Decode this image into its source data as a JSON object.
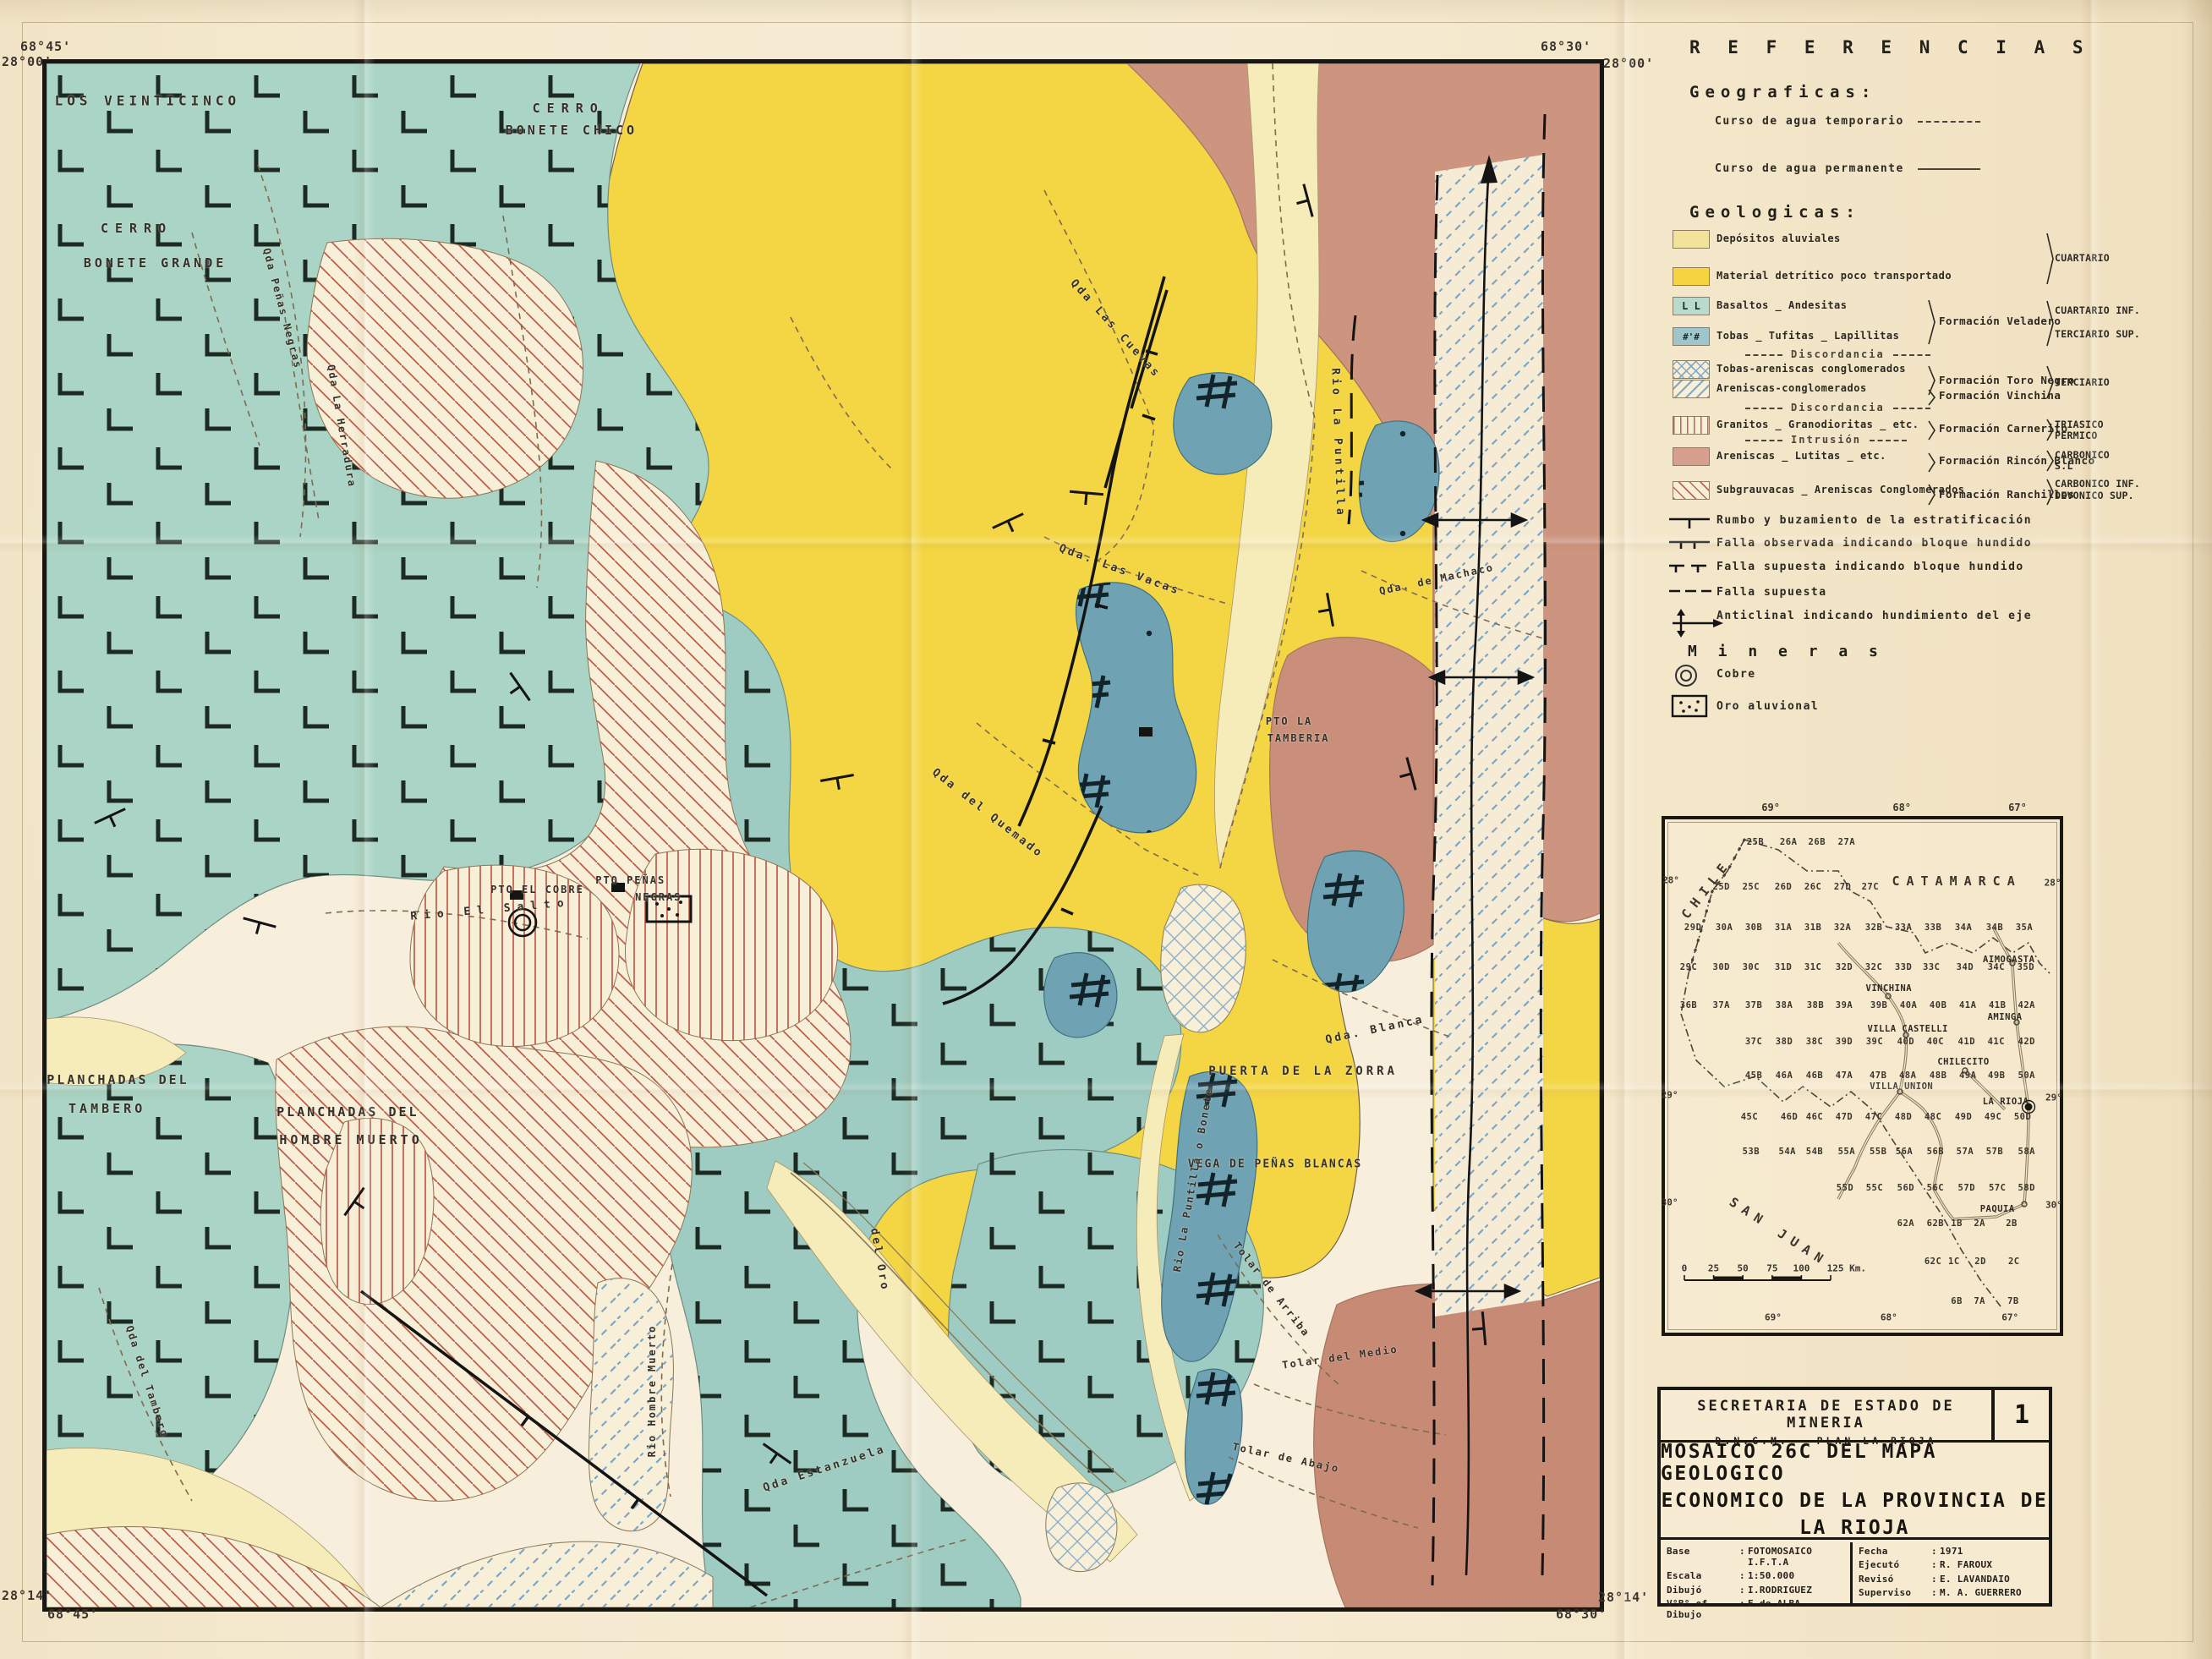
{
  "map": {
    "corners": {
      "tl_lon": "68°45'",
      "tl_lat": "28°00'",
      "tr_lon": "68°30'",
      "tr_lat": "28°00'",
      "bl_lat": "28°14'",
      "bl_lon": "68°45'",
      "br_lat": "28°14'",
      "br_lon": "68°30'"
    },
    "labels": [
      {
        "t": "LOS VEINTICINCO",
        "x": 6.5,
        "y": 2.4,
        "r": 0,
        "fs": 16,
        "ls": 5
      },
      {
        "t": "CERRO",
        "x": 33.6,
        "y": 2.9,
        "r": 0,
        "fs": 15,
        "ls": 8
      },
      {
        "t": "BONETE CHICO",
        "x": 33.8,
        "y": 4.3,
        "r": 0,
        "fs": 15,
        "ls": 4
      },
      {
        "t": "CERRO",
        "x": 5.8,
        "y": 10.7,
        "r": 0,
        "fs": 15,
        "ls": 8
      },
      {
        "t": "BONETE GRANDE",
        "x": 7.0,
        "y": 12.9,
        "r": 0,
        "fs": 15,
        "ls": 4
      },
      {
        "t": "PLANCHADAS DEL",
        "x": 4.6,
        "y": 65.8,
        "r": 0,
        "fs": 15,
        "ls": 3
      },
      {
        "t": "TAMBERO",
        "x": 3.9,
        "y": 67.7,
        "r": 0,
        "fs": 15,
        "ls": 4
      },
      {
        "t": "PLANCHADAS DEL",
        "x": 19.4,
        "y": 67.9,
        "r": 0,
        "fs": 15,
        "ls": 3
      },
      {
        "t": "HOMBRE MUERTO",
        "x": 19.6,
        "y": 69.7,
        "r": 0,
        "fs": 15,
        "ls": 4
      },
      {
        "t": "PUERTA DE LA ZORRA",
        "x": 80.9,
        "y": 65.3,
        "r": 0,
        "fs": 14,
        "ls": 4
      },
      {
        "t": "VEGA DE PEÑAS BLANCAS",
        "x": 79.1,
        "y": 71.3,
        "r": 0,
        "fs": 13,
        "ls": 2
      },
      {
        "t": "PTO LA",
        "x": 80.0,
        "y": 42.6,
        "r": 0,
        "fs": 12,
        "ls": 2
      },
      {
        "t": "TAMBERIA",
        "x": 80.6,
        "y": 43.7,
        "r": 0,
        "fs": 12,
        "ls": 2
      },
      {
        "t": "PTO EL COBRE",
        "x": 31.6,
        "y": 53.5,
        "r": 0,
        "fs": 12,
        "ls": 2
      },
      {
        "t": "PTO PEÑAS",
        "x": 37.6,
        "y": 52.9,
        "r": 0,
        "fs": 12,
        "ls": 2
      },
      {
        "t": "NEGRAS",
        "x": 39.4,
        "y": 54.0,
        "r": 0,
        "fs": 12,
        "ls": 2
      },
      {
        "t": "Qda Las Cuevas",
        "x": 68.8,
        "y": 17.2,
        "r": 48,
        "fs": 13,
        "ls": 3
      },
      {
        "t": "Qda. Las Vacas",
        "x": 69.1,
        "y": 32.8,
        "r": 20,
        "fs": 13,
        "ls": 3
      },
      {
        "t": "Rio La Puntilla",
        "x": 83.1,
        "y": 24.6,
        "r": 88,
        "fs": 13,
        "ls": 4
      },
      {
        "t": "Qda del Quemado",
        "x": 60.6,
        "y": 48.6,
        "r": 38,
        "fs": 13,
        "ls": 3
      },
      {
        "t": "Qda. Blanca",
        "x": 85.5,
        "y": 62.6,
        "r": -12,
        "fs": 13,
        "ls": 3
      },
      {
        "t": "Qda. de Machaco",
        "x": 89.5,
        "y": 33.4,
        "r": -12,
        "fs": 12,
        "ls": 2
      },
      {
        "t": "Rio El Salto",
        "x": 28.6,
        "y": 54.8,
        "r": -5,
        "fs": 13,
        "ls": 8
      },
      {
        "t": "del Oro",
        "x": 53.6,
        "y": 77.5,
        "r": 80,
        "fs": 13,
        "ls": 3
      },
      {
        "t": "Qda Estanzuela",
        "x": 50.1,
        "y": 91.0,
        "r": -18,
        "fs": 13,
        "ls": 3
      },
      {
        "t": "Rio Hombre Muerto",
        "x": 39.0,
        "y": 86.0,
        "r": -90,
        "fs": 12,
        "ls": 2
      },
      {
        "t": "Tolar de Arriba",
        "x": 78.9,
        "y": 79.4,
        "r": 52,
        "fs": 12,
        "ls": 2
      },
      {
        "t": "Tolar del Medio",
        "x": 83.3,
        "y": 83.8,
        "r": -8,
        "fs": 12,
        "ls": 2
      },
      {
        "t": "Tolar de Abajo",
        "x": 79.8,
        "y": 90.3,
        "r": 12,
        "fs": 12,
        "ls": 2
      },
      {
        "t": "Rio La Puntilla o Bonete",
        "x": 73.8,
        "y": 72.3,
        "r": -80,
        "fs": 12,
        "ls": 2
      },
      {
        "t": "Qda del Tambero",
        "x": 6.5,
        "y": 85.4,
        "r": 72,
        "fs": 12,
        "ls": 2
      },
      {
        "t": "Qda Peñas Negras",
        "x": 15.2,
        "y": 15.9,
        "r": 75,
        "fs": 12,
        "ls": 2
      },
      {
        "t": "Qda La Herradura",
        "x": 19.0,
        "y": 23.5,
        "r": 80,
        "fs": 12,
        "ls": 2
      }
    ]
  },
  "legend": {
    "title": "R E F E R E N C I A S",
    "geograficas": {
      "heading": "Geograficas:",
      "items": [
        {
          "icon": "water-dashed",
          "label": "Curso de agua temporario"
        },
        {
          "icon": "water-solid",
          "label": "Curso de agua permanente"
        }
      ]
    },
    "geologicas": {
      "heading": "Geologicas:",
      "rows": [
        {
          "kind": "unit",
          "swatch": "aluvial",
          "label": "Depósitos  aluviales"
        },
        {
          "kind": "unit",
          "swatch": "detritico",
          "label": "Material  detrítico  poco transportado"
        },
        {
          "kind": "unit",
          "swatch": "basaltos",
          "label": "Basaltos _ Andesitas"
        },
        {
          "kind": "unit",
          "swatch": "tobas",
          "label": "Tobas _ Tufitas _ Lapillitas"
        },
        {
          "kind": "sep",
          "label": "Discordancia"
        },
        {
          "kind": "unit",
          "swatch": "toronegro",
          "label": "Tobas-areniscas conglomerados"
        },
        {
          "kind": "unit",
          "swatch": "vinchina",
          "label": "Areniscas-conglomerados"
        },
        {
          "kind": "sep",
          "label": "Discordancia"
        },
        {
          "kind": "unit",
          "swatch": "granitos",
          "label": "Granitos _ Granodioritas _ etc."
        },
        {
          "kind": "sep",
          "label": "Intrusión"
        },
        {
          "kind": "unit",
          "swatch": "rincon",
          "label": "Areniscas _ Lutitas _ etc."
        },
        {
          "kind": "unit",
          "swatch": "ranchillos",
          "label": "Subgrauvacas _ Areniscas Conglomerados"
        }
      ],
      "formations": [
        {
          "label": "Formación Veladero"
        },
        {
          "label": "Formación Toro Negro"
        },
        {
          "label": "Formación Vinchina"
        },
        {
          "label": "Formación Carnerito"
        },
        {
          "label": "Formación Rincón Blanco"
        },
        {
          "label": "Formación Ranchillos"
        }
      ],
      "ages": [
        {
          "lines": [
            "CUARTARIO"
          ]
        },
        {
          "lines": [
            "CUARTARIO INF.",
            "TERCIARIO SUP."
          ]
        },
        {
          "lines": [
            "TERCIARIO"
          ]
        },
        {
          "lines": [
            "TRIASICO",
            "PERMICO"
          ]
        },
        {
          "lines": [
            "CARBONICO",
            "S.L"
          ]
        },
        {
          "lines": [
            "CARBONICO INF.",
            "DEVONICO SUP."
          ]
        }
      ]
    },
    "symbols": [
      {
        "icon": "strike-dip",
        "label": "Rumbo y buzamiento de la estratificación"
      },
      {
        "icon": "fault-observed",
        "label": "Falla observada indicando bloque hundido"
      },
      {
        "icon": "fault-supposed-block",
        "label": "Falla supuesta indicando bloque hundido"
      },
      {
        "icon": "fault-supposed",
        "label": "Falla supuesta"
      },
      {
        "icon": "anticline",
        "label": "Anticlinal  indicando hundimiento del eje"
      }
    ],
    "mineras": {
      "heading": "M i n e r a s",
      "items": [
        {
          "icon": "copper",
          "label": "Cobre"
        },
        {
          "icon": "gold",
          "label": "Oro aluvional"
        }
      ]
    }
  },
  "index_map": {
    "cells": [
      {
        "id": "25B",
        "x": 22.9,
        "y": 4.4
      },
      {
        "id": "26A",
        "x": 31.3,
        "y": 4.4
      },
      {
        "id": "26B",
        "x": 38.5,
        "y": 4.4
      },
      {
        "id": "27A",
        "x": 46.0,
        "y": 4.4
      },
      {
        "id": "25D",
        "x": 14.3,
        "y": 13.2
      },
      {
        "id": "25C",
        "x": 21.8,
        "y": 13.2
      },
      {
        "id": "26D",
        "x": 30.0,
        "y": 13.2
      },
      {
        "id": "26C",
        "x": 37.5,
        "y": 13.2
      },
      {
        "id": "27D",
        "x": 45.0,
        "y": 13.2
      },
      {
        "id": "27C",
        "x": 52.0,
        "y": 13.2
      },
      {
        "id": "29D",
        "x": 7.1,
        "y": 21.1
      },
      {
        "id": "30A",
        "x": 15.0,
        "y": 21.1
      },
      {
        "id": "30B",
        "x": 22.5,
        "y": 21.1
      },
      {
        "id": "31A",
        "x": 30.0,
        "y": 21.1
      },
      {
        "id": "31B",
        "x": 37.5,
        "y": 21.1
      },
      {
        "id": "32A",
        "x": 45.0,
        "y": 21.1
      },
      {
        "id": "32B",
        "x": 52.9,
        "y": 21.1
      },
      {
        "id": "33A",
        "x": 60.4,
        "y": 21.1
      },
      {
        "id": "33B",
        "x": 67.9,
        "y": 21.1
      },
      {
        "id": "34A",
        "x": 75.6,
        "y": 21.1
      },
      {
        "id": "34B",
        "x": 83.5,
        "y": 21.1
      },
      {
        "id": "35A",
        "x": 91.0,
        "y": 21.1
      },
      {
        "id": "29C",
        "x": 6.0,
        "y": 28.8
      },
      {
        "id": "30D",
        "x": 14.3,
        "y": 28.8
      },
      {
        "id": "30C",
        "x": 21.8,
        "y": 28.8
      },
      {
        "id": "31D",
        "x": 30.0,
        "y": 28.8
      },
      {
        "id": "31C",
        "x": 37.5,
        "y": 28.8
      },
      {
        "id": "32D",
        "x": 45.4,
        "y": 28.8
      },
      {
        "id": "32C",
        "x": 52.9,
        "y": 28.8
      },
      {
        "id": "33D",
        "x": 60.4,
        "y": 28.8
      },
      {
        "id": "33C",
        "x": 67.5,
        "y": 28.8
      },
      {
        "id": "34D",
        "x": 76.0,
        "y": 28.8
      },
      {
        "id": "34C",
        "x": 83.9,
        "y": 28.8
      },
      {
        "id": "35D",
        "x": 91.4,
        "y": 28.8
      },
      {
        "id": "36B",
        "x": 6.0,
        "y": 36.2
      },
      {
        "id": "37A",
        "x": 14.3,
        "y": 36.2
      },
      {
        "id": "37B",
        "x": 22.5,
        "y": 36.2
      },
      {
        "id": "38A",
        "x": 30.2,
        "y": 36.2
      },
      {
        "id": "38B",
        "x": 38.1,
        "y": 36.2
      },
      {
        "id": "39A",
        "x": 45.4,
        "y": 36.2
      },
      {
        "id": "39B",
        "x": 54.2,
        "y": 36.2
      },
      {
        "id": "40A",
        "x": 61.7,
        "y": 36.2
      },
      {
        "id": "40B",
        "x": 69.2,
        "y": 36.2
      },
      {
        "id": "41A",
        "x": 76.7,
        "y": 36.2
      },
      {
        "id": "41B",
        "x": 84.2,
        "y": 36.2
      },
      {
        "id": "42A",
        "x": 91.6,
        "y": 36.2
      },
      {
        "id": "37C",
        "x": 22.5,
        "y": 43.3
      },
      {
        "id": "38D",
        "x": 30.2,
        "y": 43.3
      },
      {
        "id": "38C",
        "x": 37.9,
        "y": 43.3
      },
      {
        "id": "39D",
        "x": 45.4,
        "y": 43.3
      },
      {
        "id": "39C",
        "x": 53.1,
        "y": 43.3
      },
      {
        "id": "40D",
        "x": 61.0,
        "y": 43.3
      },
      {
        "id": "40C",
        "x": 68.5,
        "y": 43.3
      },
      {
        "id": "41D",
        "x": 76.4,
        "y": 43.3
      },
      {
        "id": "41C",
        "x": 83.9,
        "y": 43.3
      },
      {
        "id": "42D",
        "x": 91.6,
        "y": 43.3
      },
      {
        "id": "45B",
        "x": 22.5,
        "y": 49.9
      },
      {
        "id": "46A",
        "x": 30.2,
        "y": 49.9
      },
      {
        "id": "46B",
        "x": 37.9,
        "y": 49.9
      },
      {
        "id": "47A",
        "x": 45.4,
        "y": 49.9
      },
      {
        "id": "47B",
        "x": 54.0,
        "y": 49.9
      },
      {
        "id": "48A",
        "x": 61.5,
        "y": 49.9
      },
      {
        "id": "48B",
        "x": 69.2,
        "y": 49.9
      },
      {
        "id": "49A",
        "x": 76.7,
        "y": 49.9
      },
      {
        "id": "49B",
        "x": 84.0,
        "y": 49.9
      },
      {
        "id": "50A",
        "x": 91.6,
        "y": 49.9
      },
      {
        "id": "45C",
        "x": 21.4,
        "y": 58.0
      },
      {
        "id": "46D",
        "x": 31.5,
        "y": 58.0
      },
      {
        "id": "46C",
        "x": 37.9,
        "y": 58.0
      },
      {
        "id": "47D",
        "x": 45.4,
        "y": 58.0
      },
      {
        "id": "47C",
        "x": 52.9,
        "y": 58.0
      },
      {
        "id": "48D",
        "x": 60.4,
        "y": 58.0
      },
      {
        "id": "48C",
        "x": 67.9,
        "y": 58.0
      },
      {
        "id": "49D",
        "x": 75.6,
        "y": 58.0
      },
      {
        "id": "49C",
        "x": 83.1,
        "y": 58.0
      },
      {
        "id": "50D",
        "x": 90.6,
        "y": 58.0
      },
      {
        "id": "53B",
        "x": 21.8,
        "y": 64.7
      },
      {
        "id": "54A",
        "x": 31.0,
        "y": 64.7
      },
      {
        "id": "54B",
        "x": 37.9,
        "y": 64.7
      },
      {
        "id": "55A",
        "x": 46.0,
        "y": 64.7
      },
      {
        "id": "55B",
        "x": 54.0,
        "y": 64.7
      },
      {
        "id": "56A",
        "x": 60.6,
        "y": 64.7
      },
      {
        "id": "56B",
        "x": 68.5,
        "y": 64.7
      },
      {
        "id": "57A",
        "x": 76.0,
        "y": 64.7
      },
      {
        "id": "57B",
        "x": 83.5,
        "y": 64.7
      },
      {
        "id": "58A",
        "x": 91.6,
        "y": 64.7
      },
      {
        "id": "55D",
        "x": 45.6,
        "y": 71.8
      },
      {
        "id": "55C",
        "x": 53.1,
        "y": 71.8
      },
      {
        "id": "56D",
        "x": 61.0,
        "y": 71.8
      },
      {
        "id": "56C",
        "x": 68.5,
        "y": 71.8
      },
      {
        "id": "57D",
        "x": 76.4,
        "y": 71.8
      },
      {
        "id": "57C",
        "x": 84.2,
        "y": 71.8
      },
      {
        "id": "58D",
        "x": 91.6,
        "y": 71.8
      },
      {
        "id": "62A",
        "x": 61.0,
        "y": 78.7
      },
      {
        "id": "62B",
        "x": 68.5,
        "y": 78.7
      },
      {
        "id": "1B",
        "x": 73.9,
        "y": 78.7
      },
      {
        "id": "2A",
        "x": 79.7,
        "y": 78.7
      },
      {
        "id": "2B",
        "x": 87.8,
        "y": 78.7
      },
      {
        "id": "62C",
        "x": 67.9,
        "y": 86.2
      },
      {
        "id": "1C",
        "x": 73.2,
        "y": 86.2
      },
      {
        "id": "2D",
        "x": 79.9,
        "y": 86.2
      },
      {
        "id": "2C",
        "x": 88.4,
        "y": 86.2
      },
      {
        "id": "6B",
        "x": 73.9,
        "y": 93.9
      },
      {
        "id": "7A",
        "x": 79.7,
        "y": 93.9
      },
      {
        "id": "7B",
        "x": 88.2,
        "y": 93.9
      }
    ],
    "towns": [
      {
        "name": "AIMOGASTA",
        "x": 87.1,
        "y": 27.3
      },
      {
        "name": "VINCHINA",
        "x": 56.7,
        "y": 33.0
      },
      {
        "name": "AMINGA",
        "x": 86.1,
        "y": 38.6
      },
      {
        "name": "VILLA CASTELLI",
        "x": 61.5,
        "y": 40.8
      },
      {
        "name": "CHILECITO",
        "x": 75.6,
        "y": 47.2
      },
      {
        "name": "VILLA UNION",
        "x": 59.9,
        "y": 52.0
      },
      {
        "name": "LA RIOJA",
        "x": 86.3,
        "y": 55.0
      },
      {
        "name": "PAQUIA",
        "x": 84.2,
        "y": 76.0
      }
    ],
    "regions": [
      {
        "name": "CHILE",
        "x": 10.5,
        "y": 13.5,
        "r": -52
      },
      {
        "name": "CATAMARCA",
        "x": 73.9,
        "y": 12.0,
        "r": 0
      },
      {
        "name": "SAN JUAN",
        "x": 28.9,
        "y": 80.4,
        "r": 33
      }
    ],
    "lat_labels": [
      {
        "t": "28°",
        "x": 1.5,
        "y": 11.9
      },
      {
        "t": "28°",
        "x": 98.2,
        "y": 12.4
      },
      {
        "t": "29°",
        "x": 1.2,
        "y": 53.7
      },
      {
        "t": "29°",
        "x": 98.5,
        "y": 54.2
      },
      {
        "t": "30°",
        "x": 1.2,
        "y": 74.6
      },
      {
        "t": "30°",
        "x": 98.5,
        "y": 75.2
      }
    ],
    "lon_labels_top": [
      {
        "t": "69°",
        "x": 26.8
      },
      {
        "t": "68°",
        "x": 60.0
      },
      {
        "t": "67°",
        "x": 89.3
      }
    ],
    "lon_labels_bottom": [
      {
        "t": "69°",
        "x": 27.4
      },
      {
        "t": "68°",
        "x": 56.7
      },
      {
        "t": "67°",
        "x": 87.4
      }
    ],
    "scale": {
      "ticks": [
        "0",
        "25",
        "50",
        "75",
        "100"
      ],
      "end": "125 Km."
    }
  },
  "title_block": {
    "org": "SECRETARIA  DE  ESTADO  DE  MINERIA",
    "sub": "D.N.G.M. — PLAN  LA  RIOJA",
    "sheet_no": "1",
    "title_lines": [
      "MOSAICO 26C DEL MAPA GEOLOGICO",
      "ECONOMICO  DE LA  PROVINCIA  DE",
      "LA RIOJA"
    ],
    "fields_left": [
      {
        "k": "Base",
        "v": "FOTOMOSAICO  I.F.T.A"
      },
      {
        "k": "Escala",
        "v": "1:50.000"
      },
      {
        "k": "Dibujó",
        "v": "I.RODRIGUEZ"
      },
      {
        "k": "V°B° of Dibujo",
        "v": "E.de ALBA"
      }
    ],
    "fields_right": [
      {
        "k": "Fecha",
        "v": "1971"
      },
      {
        "k": "Ejecutó",
        "v": "R. FAROUX"
      },
      {
        "k": "Revisó",
        "v": "E. LAVANDAIO"
      },
      {
        "k": "Superviso",
        "v": "M. A. GUERRERO"
      }
    ]
  },
  "colors": {
    "teal": "#a9d4c6",
    "teal_dark": "#6fa3b4",
    "yellow": "#f4d644",
    "pale_yellow": "#f6ecb9",
    "pink": "#cd947f",
    "hatch_red": "#bc5c49",
    "hatch_blue": "#7ea6c4",
    "ink": "#181712",
    "paper": "#f7eedc"
  }
}
